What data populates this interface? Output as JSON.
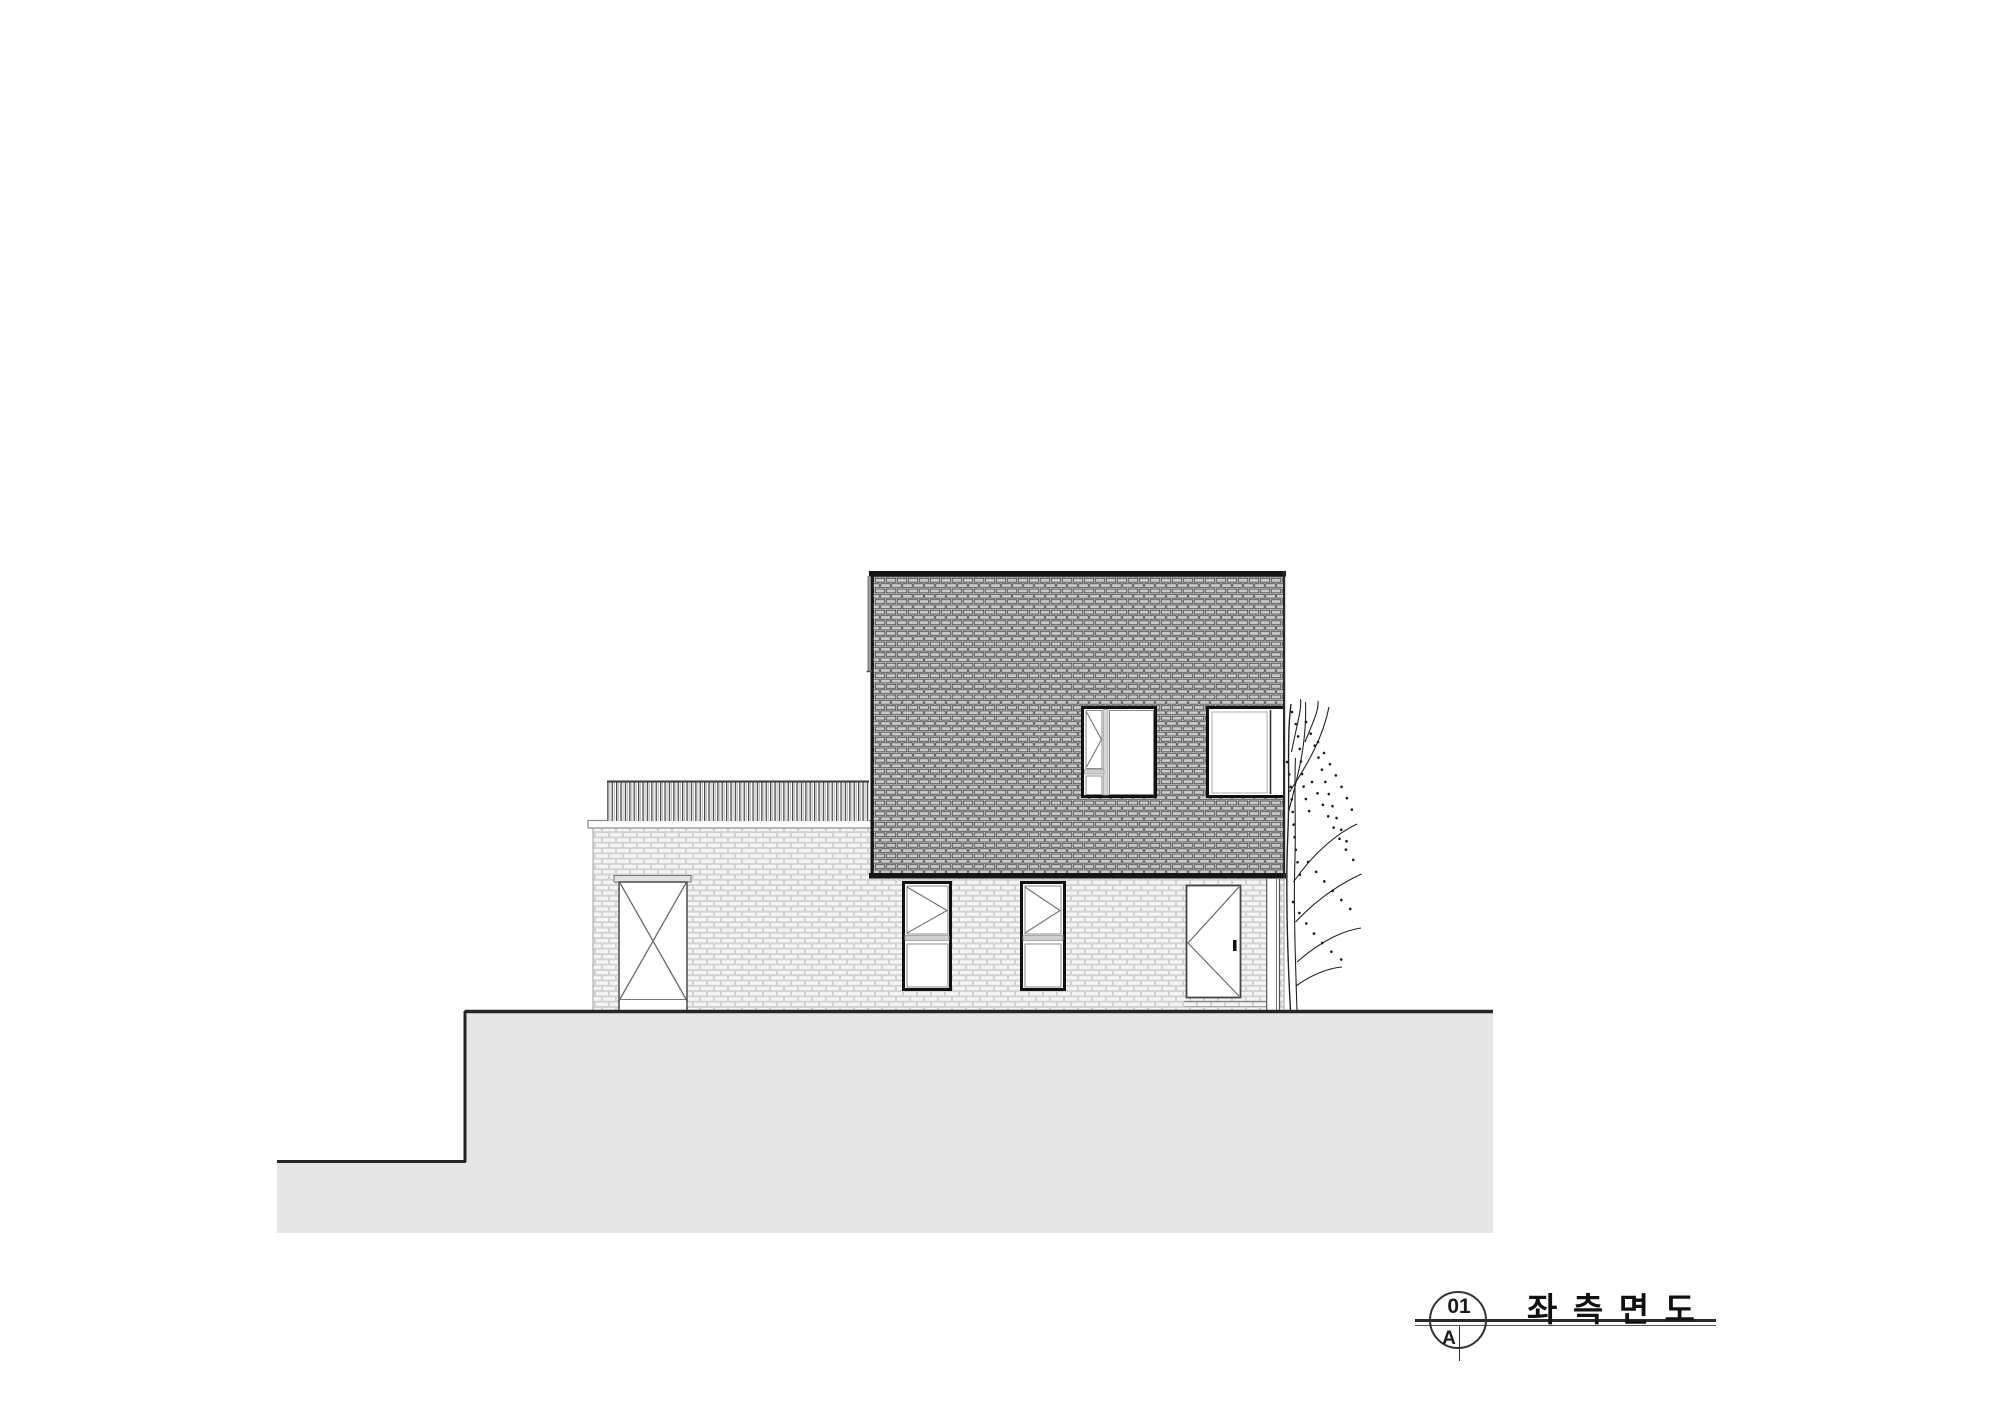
{
  "page": {
    "background": "#ffffff"
  },
  "title_block": {
    "view_number": "01",
    "sheet_letter": "A",
    "view_title": "좌 측 면 도"
  },
  "colors": {
    "line_dark": "#151515",
    "ground_fill": "#e6e6e6",
    "upper_brick_fill": "#c9c9c9",
    "upper_brick_joint": "#3a3a3a",
    "lower_brick_fill": "#f4f4f4",
    "lower_brick_joint": "#c4c4c4"
  }
}
